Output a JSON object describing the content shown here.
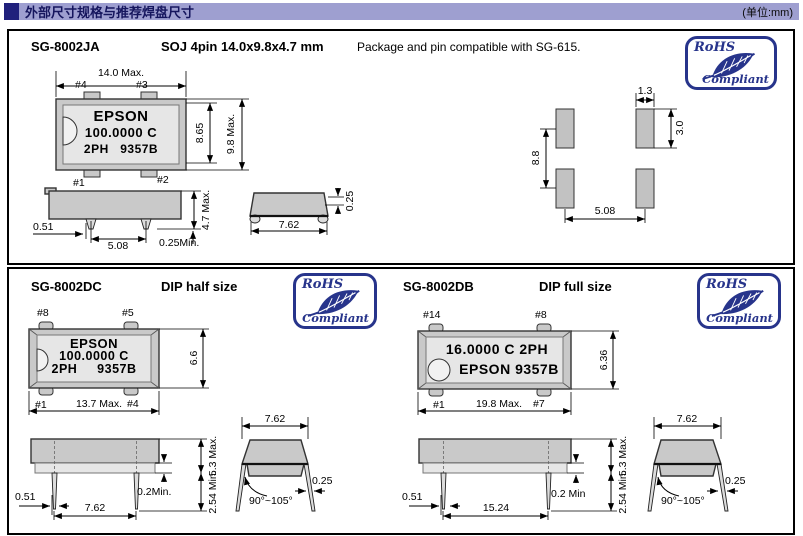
{
  "header": {
    "title": "外部尺寸规格与推荐焊盘尺寸",
    "unit_label": "(单位:mm)"
  },
  "rohs_badge": {
    "top": "RoHS",
    "bottom": "Compliant"
  },
  "colors": {
    "header_bar": "#9e9fd0",
    "header_square": "#20207c",
    "rohs_blue": "#27348b",
    "package_fill": "#c9c9c9"
  },
  "panel_ja": {
    "model": "SG-8002JA",
    "package_label": "SOJ 4pin 14.0x9.8x4.7 mm",
    "compat_note": "Package and pin compatible with SG-615.",
    "marking": {
      "line1": "EPSON",
      "line2": "100.0000 C",
      "line3": "2PH   9357B"
    },
    "pins": {
      "top_left": "#4",
      "top_right": "#3",
      "bottom_left": "#1",
      "bottom_right": "#2"
    },
    "dims": {
      "body_width": "14.0 Max.",
      "lead_span": "8.65",
      "body_depth": "9.8 Max.",
      "lead_width": "0.51",
      "lead_pitch": "5.08",
      "body_height": "4.7 Max.",
      "standoff": "0.25Min.",
      "lead_row_span": "7.62",
      "lead_thickness": "0.25"
    },
    "land_pattern": {
      "pad_width": "1.3",
      "pad_height": "3.0",
      "row_pitch": "8.8",
      "column_pitch": "5.08"
    }
  },
  "panel_dc": {
    "model": "SG-8002DC",
    "package_label": "DIP half size",
    "marking": {
      "line1": "EPSON",
      "line2": "100.0000 C",
      "line3": "2PH     9357B"
    },
    "pins": {
      "top_left": "#8",
      "top_right": "#5",
      "bottom_left": "#1",
      "bottom_right": "#4"
    },
    "dims": {
      "body_height": "6.6",
      "body_width": "13.7 Max.",
      "lead_width": "0.51",
      "lead_pitch": "7.62",
      "standoff": "0.2Min.",
      "profile_height": "5.3 Max.",
      "lead_length": "2.54 Min.",
      "lead_row_span": "7.62",
      "lead_thickness": "0.25",
      "lead_angle": "90°~105°"
    }
  },
  "panel_db": {
    "model": "SG-8002DB",
    "package_label": "DIP full size",
    "marking": {
      "line1": "16.0000 C 2PH",
      "line2": "EPSON 9357B"
    },
    "pins": {
      "top_left": "#14",
      "top_right": "#8",
      "bottom_left": "#1",
      "bottom_right": "#7"
    },
    "dims": {
      "body_height": "6.36",
      "body_width": "19.8 Max.",
      "lead_width": "0.51",
      "lead_pitch": "15.24",
      "standoff": "0.2 Min",
      "profile_height": "5.3 Max.",
      "lead_length": "2.54 Min.",
      "lead_row_span": "7.62",
      "lead_thickness": "0.25",
      "lead_angle": "90°~105°"
    }
  }
}
